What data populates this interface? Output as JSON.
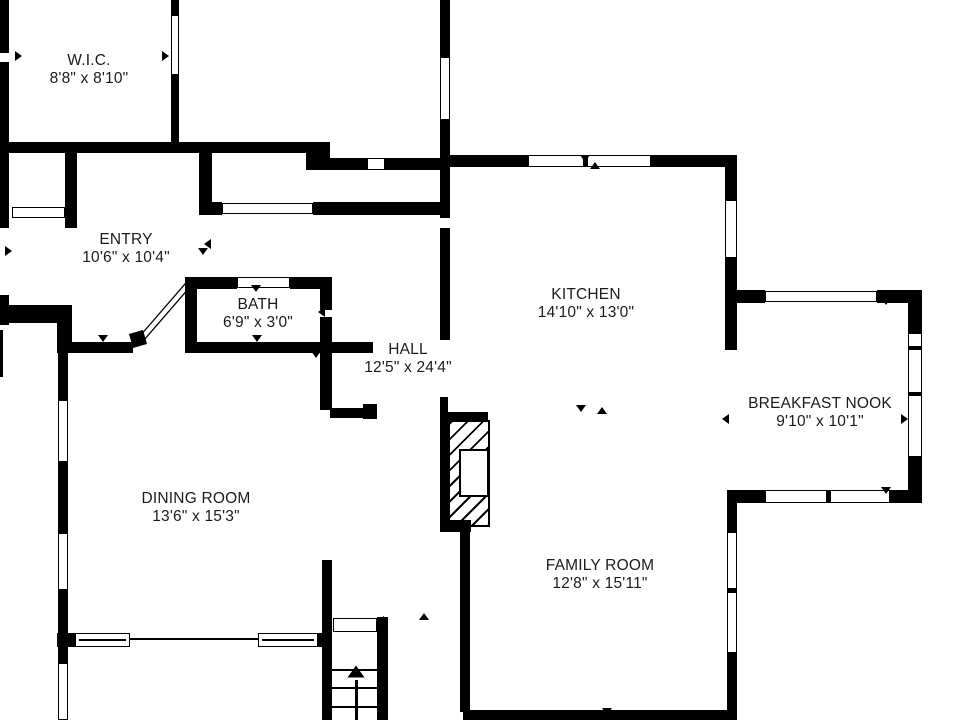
{
  "plan": {
    "background_color": "#ffffff",
    "wall_color": "#000000",
    "rooms": [
      {
        "id": "wic",
        "name": "W.I.C.",
        "dims": "8'8\" x 8'10\"",
        "cx": 89,
        "top": 52
      },
      {
        "id": "entry",
        "name": "ENTRY",
        "dims": "10'6\" x 10'4\"",
        "cx": 126,
        "top": 231
      },
      {
        "id": "bath",
        "name": "BATH",
        "dims": "6'9\" x 3'0\"",
        "cx": 258,
        "top": 296
      },
      {
        "id": "hall",
        "name": "HALL",
        "dims": "12'5\" x 24'4\"",
        "cx": 408,
        "top": 341
      },
      {
        "id": "kitchen",
        "name": "KITCHEN",
        "dims": "14'10\" x 13'0\"",
        "cx": 586,
        "top": 286
      },
      {
        "id": "breakfast-nook",
        "name": "BREAKFAST NOOK",
        "dims": "9'10\" x 10'1\"",
        "cx": 820,
        "top": 395
      },
      {
        "id": "dining-room",
        "name": "DINING ROOM",
        "dims": "13'6\" x 15'3\"",
        "cx": 196,
        "top": 490
      },
      {
        "id": "family-room",
        "name": "FAMILY ROOM",
        "dims": "12'8\" x 15'11\"",
        "cx": 600,
        "top": 557
      }
    ],
    "walls": [
      [
        0,
        0,
        9,
        53
      ],
      [
        0,
        62,
        9,
        166
      ],
      [
        0,
        295,
        9,
        30
      ],
      [
        0,
        305,
        60,
        18
      ],
      [
        0,
        330,
        3,
        47
      ],
      [
        57,
        305,
        15,
        48
      ],
      [
        58,
        343,
        10,
        57
      ],
      [
        58,
        462,
        10,
        71
      ],
      [
        58,
        590,
        10,
        73
      ],
      [
        65,
        148,
        12,
        80
      ],
      [
        171,
        0,
        8,
        15
      ],
      [
        171,
        75,
        8,
        70
      ],
      [
        0,
        142,
        330,
        11
      ],
      [
        306,
        143,
        24,
        27
      ],
      [
        323,
        158,
        44,
        12
      ],
      [
        385,
        158,
        55,
        12
      ],
      [
        199,
        153,
        13,
        60
      ],
      [
        199,
        202,
        23,
        13
      ],
      [
        313,
        202,
        127,
        13
      ],
      [
        185,
        277,
        52,
        12
      ],
      [
        290,
        277,
        42,
        12
      ],
      [
        185,
        280,
        12,
        73
      ],
      [
        320,
        277,
        12,
        33
      ],
      [
        320,
        317,
        12,
        36
      ],
      [
        57,
        342,
        76,
        11
      ],
      [
        188,
        342,
        185,
        11
      ],
      [
        320,
        353,
        12,
        57
      ],
      [
        330,
        408,
        47,
        10
      ],
      [
        363,
        404,
        14,
        15
      ],
      [
        322,
        560,
        10,
        160
      ],
      [
        377,
        617,
        11,
        103
      ],
      [
        57,
        633,
        18,
        14
      ],
      [
        318,
        633,
        14,
        14
      ],
      [
        440,
        0,
        10,
        57
      ],
      [
        440,
        120,
        10,
        98
      ],
      [
        440,
        228,
        10,
        112
      ],
      [
        440,
        397,
        8,
        133
      ],
      [
        460,
        527,
        10,
        185
      ],
      [
        443,
        155,
        85,
        12
      ],
      [
        651,
        155,
        86,
        12
      ],
      [
        725,
        155,
        12,
        45
      ],
      [
        725,
        258,
        12,
        92
      ],
      [
        725,
        290,
        40,
        13
      ],
      [
        877,
        290,
        45,
        13
      ],
      [
        908,
        290,
        14,
        43
      ],
      [
        908,
        457,
        14,
        46
      ],
      [
        727,
        490,
        38,
        13
      ],
      [
        890,
        490,
        32,
        13
      ],
      [
        727,
        490,
        10,
        42
      ],
      [
        727,
        653,
        10,
        59
      ],
      [
        463,
        710,
        274,
        10
      ],
      [
        443,
        412,
        45,
        9
      ],
      [
        440,
        520,
        31,
        12
      ]
    ],
    "windows": [
      [
        12,
        207,
        53,
        11
      ],
      [
        58,
        400,
        10,
        62
      ],
      [
        58,
        533,
        10,
        57
      ],
      [
        58,
        663,
        10,
        57
      ],
      [
        222,
        203,
        91,
        11
      ],
      [
        440,
        57,
        10,
        63
      ],
      [
        528,
        155,
        123,
        12
      ],
      [
        725,
        200,
        12,
        58
      ],
      [
        908,
        333,
        14,
        124
      ],
      [
        765,
        490,
        125,
        13
      ],
      [
        727,
        532,
        10,
        121
      ],
      [
        75,
        633,
        55,
        14
      ],
      [
        258,
        633,
        60,
        14
      ],
      [
        367,
        158,
        18,
        12
      ],
      [
        237,
        277,
        53,
        11
      ],
      [
        765,
        291,
        112,
        11
      ],
      [
        333,
        618,
        44,
        14
      ],
      [
        171,
        15,
        8,
        60
      ]
    ],
    "lines": [
      [
        583,
        155,
        5,
        12
      ],
      [
        826,
        490,
        5,
        13
      ],
      [
        908,
        346,
        14,
        4
      ],
      [
        908,
        392,
        14,
        4
      ],
      [
        727,
        588,
        10,
        5
      ],
      [
        130,
        638,
        128,
        2
      ],
      [
        79,
        639,
        47,
        2
      ],
      [
        262,
        639,
        52,
        2
      ],
      [
        332,
        669,
        45,
        2
      ],
      [
        332,
        687,
        45,
        2
      ],
      [
        332,
        706,
        45,
        2
      ],
      [
        355,
        680,
        3,
        40
      ]
    ],
    "markers": [
      {
        "d": "right",
        "x": 20,
        "y": 57
      },
      {
        "d": "right",
        "x": 167,
        "y": 57
      },
      {
        "d": "right",
        "x": 10,
        "y": 252
      },
      {
        "d": "left",
        "x": 209,
        "y": 245
      },
      {
        "d": "down",
        "x": 203,
        "y": 254
      },
      {
        "d": "down",
        "x": 103,
        "y": 341
      },
      {
        "d": "down",
        "x": 257,
        "y": 341
      },
      {
        "d": "down",
        "x": 316,
        "y": 357
      },
      {
        "d": "down",
        "x": 585,
        "y": 161
      },
      {
        "d": "up",
        "x": 595,
        "y": 168
      },
      {
        "d": "down",
        "x": 581,
        "y": 411
      },
      {
        "d": "up",
        "x": 602,
        "y": 413
      },
      {
        "d": "left",
        "x": 727,
        "y": 420
      },
      {
        "d": "right",
        "x": 906,
        "y": 420
      },
      {
        "d": "down",
        "x": 886,
        "y": 304
      },
      {
        "d": "down",
        "x": 886,
        "y": 493
      },
      {
        "d": "down",
        "x": 607,
        "y": 714
      },
      {
        "d": "up",
        "x": 424,
        "y": 619
      },
      {
        "d": "left",
        "x": 382,
        "y": 622
      },
      {
        "d": "down",
        "x": 256,
        "y": 291
      },
      {
        "d": "left",
        "x": 323,
        "y": 313
      },
      {
        "d": "up",
        "x": 356,
        "y": 674,
        "big": true
      }
    ],
    "fireplace": {
      "hatch": [
        448,
        420,
        42,
        107
      ],
      "firebox": [
        459,
        449,
        30,
        48
      ]
    },
    "door_swing": {
      "leaf": "140,336 185,284 189,288 144,340",
      "hinge": "129,334 143,330 147,344 133,348"
    }
  }
}
